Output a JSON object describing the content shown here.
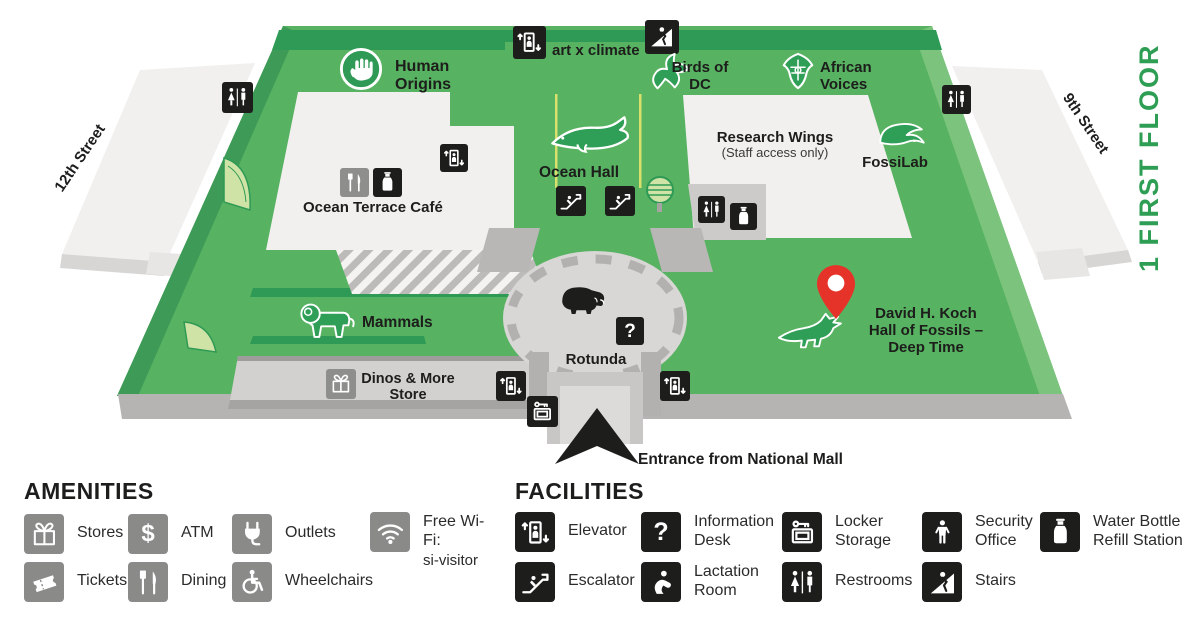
{
  "colors": {
    "map_green": "#57b261",
    "band_green": "#2e9a55",
    "floor_label_green": "#2f9e55",
    "icon_black": "#1d1d1b",
    "amenity_gray": "#8a8a88",
    "pin_red": "#e63329",
    "wing_white": "#f1f0ee"
  },
  "map": {
    "floor_label": "1  FIRST FLOOR",
    "west_street": "12th Street",
    "east_street": "9th Street",
    "entrance_label": "Entrance from National Mall",
    "labels": {
      "human_origins": "Human Origins",
      "art_x_climate": "art x climate",
      "birds_of_dc": "Birds of DC",
      "african_voices": "African Voices",
      "ocean_hall": "Ocean Hall",
      "research_wings": "Research Wings",
      "research_wings_note": "(Staff access only)",
      "fossilab": "FossiLab",
      "ocean_terrace_cafe": "Ocean Terrace Café",
      "mammals": "Mammals",
      "rotunda": "Rotunda",
      "koch_hall": "David H. Koch Hall of Fossils – Deep Time",
      "dinos_store": "Dinos & More Store"
    },
    "icons": {
      "information_desk": "?",
      "atm": "$"
    }
  },
  "legend": {
    "amenities": {
      "title": "AMENITIES",
      "items": [
        {
          "icon": "stores-icon",
          "label": "Stores"
        },
        {
          "icon": "atm-icon",
          "label": "ATM",
          "glyph": "$"
        },
        {
          "icon": "outlets-icon",
          "label": "Outlets"
        },
        {
          "icon": "wifi-icon",
          "label": "Free Wi-Fi:",
          "sublabel": "si-visitor"
        },
        {
          "icon": "tickets-icon",
          "label": "Tickets"
        },
        {
          "icon": "dining-icon",
          "label": "Dining"
        },
        {
          "icon": "wheelchairs-icon",
          "label": "Wheelchairs"
        }
      ]
    },
    "facilities": {
      "title": "FACILITIES",
      "items": [
        {
          "icon": "elevator-icon",
          "label": "Elevator"
        },
        {
          "icon": "information-desk-icon",
          "label": "Information Desk",
          "glyph": "?"
        },
        {
          "icon": "locker-storage-icon",
          "label": "Locker Storage"
        },
        {
          "icon": "security-office-icon",
          "label": "Security Office"
        },
        {
          "icon": "water-bottle-refill-icon",
          "label": "Water Bottle Refill Station"
        },
        {
          "icon": "escalator-icon",
          "label": "Escalator"
        },
        {
          "icon": "lactation-room-icon",
          "label": "Lactation Room"
        },
        {
          "icon": "restrooms-icon",
          "label": "Restrooms"
        },
        {
          "icon": "stairs-icon",
          "label": "Stairs"
        }
      ]
    }
  }
}
